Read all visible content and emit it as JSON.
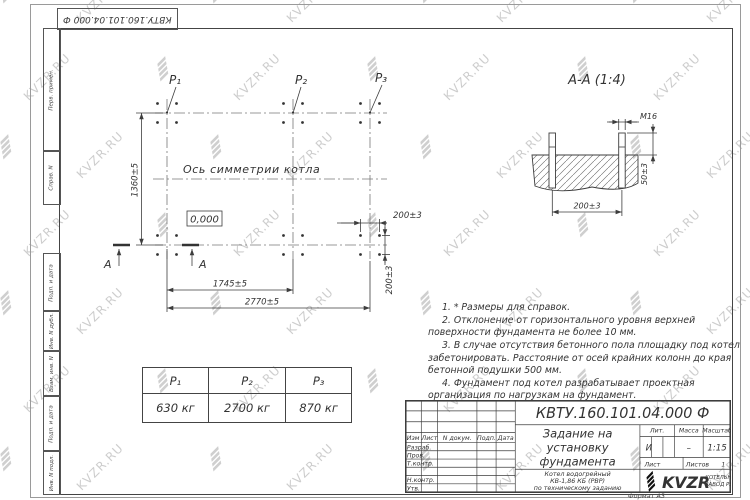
{
  "watermark": {
    "text": "KVZR.RU"
  },
  "frame": {
    "top_doc_number": "КВТУ.160.101.04.000 Ф",
    "left_labels": [
      "Перв. примен.",
      "Справ. N",
      "Подп. и дата",
      "Инв. N дубл.",
      "Взам. инв. N",
      "Подп. и дата",
      "Инв. N подл."
    ],
    "format_label": "Формат А3"
  },
  "plan": {
    "p1": "P₁",
    "p2": "P₂",
    "p3": "P₃",
    "axis_label": "Ось симметрии котла",
    "level_mark": "0,000",
    "section_letter": "А",
    "dim_height": "1360±5",
    "dim_to_p2": "1745±5",
    "dim_to_p3": "2770±5",
    "dim_bolt_spacing_x": "200±3",
    "dim_bolt_spacing_y": "200±3"
  },
  "section": {
    "title": "А-А (1:4)",
    "thread_label": "М16",
    "dim_bolt_spacing": "200±3",
    "dim_protrusion": "50±3"
  },
  "loads": {
    "headers": [
      "P₁",
      "P₂",
      "P₃"
    ],
    "values": [
      "630 кг",
      "2700 кг",
      "870 кг"
    ]
  },
  "notes": [
    "1. * Размеры для справок.",
    "2. Отклонение от горизонтального уровня верхней поверхности фундамента не более 10 мм.",
    "3. В случае отсутствия бетонного пола площадку под котел забетонировать. Расстояние от осей крайних колонн до края бетонной подушки 500 мм.",
    "4. Фундамент под котел разрабатывает проектная организация по нагрузкам на фундамент."
  ],
  "title_block": {
    "doc_number": "КВТУ.160.101.04.000  Ф",
    "title_line1": "Задание на",
    "title_line2": "установку",
    "title_line3": "фундамента",
    "product_line1": "Котел водогрейный",
    "product_line2": "КВ-1,86 КБ (РВР)",
    "product_line3": "по техническому заданию",
    "hdr_izm": "Изм",
    "hdr_list": "Лист",
    "hdr_ndoc": "N докум.",
    "hdr_podp": "Подп.",
    "hdr_data": "Дата",
    "row_razrab": "Разраб.",
    "row_prov": "Пров.",
    "row_tkontr": "Т.контр.",
    "row_nkontr": "Н.контр.",
    "row_utv": "Утв.",
    "lit_label": "Лит.",
    "mass_label": "Масса",
    "scale_label": "Масштаб",
    "lit_value": "И",
    "mass_value": "–",
    "scale_value": "1:15",
    "sheet_label": "Лист",
    "sheets_label": "Листов",
    "sheets_value": "1",
    "logo_text": "KVZR",
    "logo_caption1": "КОТЕЛЬНЫЙ",
    "logo_caption2": "ЗАВОД РЭП"
  },
  "colors": {
    "line": "#3d3d3d",
    "watermark": "#cdcdcd",
    "background": "#ffffff"
  }
}
